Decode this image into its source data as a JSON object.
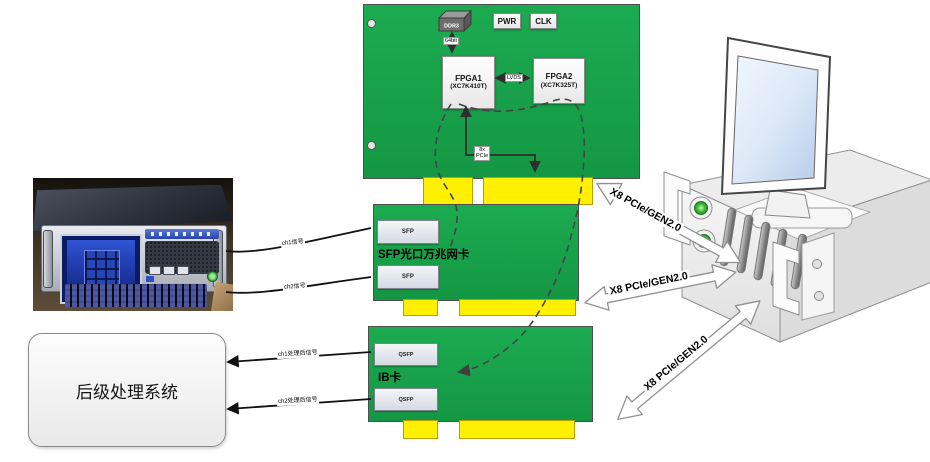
{
  "board1": {
    "ddr3": "DDR3",
    "pwr": "PWR",
    "clk": "CLK",
    "fpga1_name": "FPGA1",
    "fpga1_part": "(XC7K410T)",
    "fpga2_name": "FPGA2",
    "fpga2_part": "(XC7K325T)",
    "ddr_bus": "64bit",
    "fpga_link": "LVDS",
    "pcie_bus_l1": "8x",
    "pcie_bus_l2": "PCIe"
  },
  "sfp_card": {
    "port_top": "SFP",
    "port_bottom": "SFP",
    "title": "SFP光口万兆网卡"
  },
  "ib_card": {
    "port_top": "QSFP",
    "port_bottom": "QSFP",
    "title": "IB卡"
  },
  "post_system": {
    "title": "后级处理系统"
  },
  "links": {
    "pcie_top": "X8 PCIe/GEN2.0",
    "pcie_mid": "X8 PCIe/GEN2.0",
    "pcie_bottom": "X8 PCIe/GEN2.0",
    "wire_in1": "ch1信号",
    "wire_in2": "ch2信号",
    "wire_out1": "ch1处理后信号",
    "wire_out2": "ch2处理后信号"
  },
  "colors": {
    "pcb_green": "#1cab50",
    "connector_yellow": "#ffef00",
    "led_green": "#2fa12f"
  }
}
